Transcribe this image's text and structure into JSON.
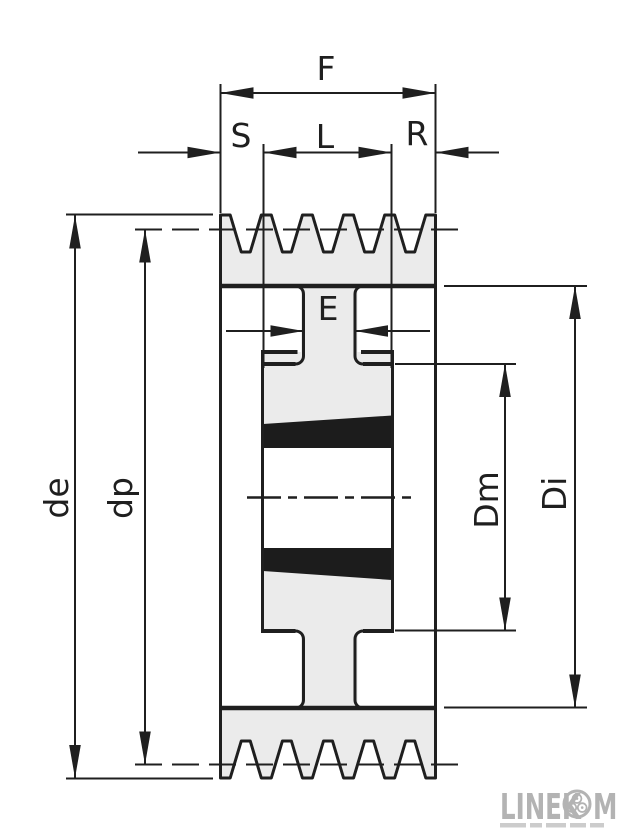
{
  "title": "V-belt pulley with taper bush - dimensioned cross-section",
  "labels": {
    "F": "F",
    "S": "S",
    "L": "L",
    "R": "R",
    "E": "E",
    "de": "de",
    "dp": "dp",
    "Dm": "Dm",
    "Di": "Di"
  },
  "colors": {
    "outline": "#1f1f1f",
    "section_fill": "#ebebeb",
    "background": "#ffffff",
    "taper_fill": "#1c1c1c",
    "logo_gray": "#b3b3b3",
    "tagline_gray": "#cccccc"
  },
  "logo": {
    "text_left": "LINEK",
    "text_right": "M",
    "badge": "three-roller-chain-badge",
    "tagline_legible": false
  },
  "geometry": {
    "canvas": {
      "w": 644,
      "h": 839
    },
    "pulley": {
      "left": 220.5,
      "right": 435.5,
      "top": 215,
      "bottom": 778,
      "groove_count": 5,
      "groove_floor_top": 252,
      "groove_floor_bottom": 741,
      "peak_flat": 10,
      "floor_w": 9,
      "rim_face_top": 286,
      "rim_face_bottom": 708,
      "web_left": 303.5,
      "web_right": 355,
      "hub_left": 262.5,
      "hub_right": 392.5,
      "hub_lip_top": 352,
      "hub_face_top": 364,
      "hub_face_bottom": 631,
      "bore_top": 448,
      "bore_bottom": 548,
      "band_top": [
        [
          263,
          424
        ],
        [
          392,
          415.5
        ],
        [
          392,
          448
        ],
        [
          263,
          448
        ]
      ],
      "band_bottom": [
        [
          263,
          548
        ],
        [
          392,
          548
        ],
        [
          392,
          580
        ],
        [
          263,
          571
        ]
      ],
      "center_y": 497.5,
      "center_x1": 247,
      "center_x2": 413,
      "fillet_r": 8
    },
    "dims": {
      "F": {
        "y": 93,
        "x1": 220.5,
        "x2": 435.5,
        "ext_y1": 84,
        "ext_y2": 213,
        "label": [
          326,
          80
        ]
      },
      "S": {
        "y": 152.5,
        "tail_x": 138,
        "tip_x": 220.5,
        "label": [
          241,
          147
        ]
      },
      "L": {
        "y": 152.5,
        "x1": 263.5,
        "x2": 391.5,
        "ext_y1": 144,
        "ext_y2": 368,
        "label": [
          325,
          148
        ]
      },
      "R": {
        "y": 152.5,
        "tail_x": 499,
        "tip_x": 435.5,
        "label": [
          417,
          145
        ]
      },
      "E": {
        "y": 331,
        "tail_left": 226,
        "tip_left": 303.5,
        "tip_right": 355,
        "tail_right": 430,
        "label": [
          328,
          320
        ]
      },
      "de": {
        "x": 75,
        "y1": 215.5,
        "y2": 778,
        "ext_x1": 66,
        "ext_x2": 213,
        "ext_y1": 214.5,
        "ext_y2": 778.5,
        "label": [
          68,
          498,
          -90
        ]
      },
      "dp": {
        "x": 145,
        "y1": 229.5,
        "y2": 764.5,
        "dash_x1": 135,
        "dash_x2": 459,
        "label": [
          132,
          498,
          -90
        ]
      },
      "Dm": {
        "x": 505,
        "y1": 364,
        "y2": 630.5,
        "ext_x1": 395,
        "ext_x2": 516,
        "label": [
          498,
          500,
          -90
        ]
      },
      "Di": {
        "x": 575,
        "y1": 286,
        "y2": 707.5,
        "ext_x1": 444,
        "ext_x2": 587,
        "label": [
          566,
          494,
          -90
        ]
      }
    },
    "logo_box": {
      "x": 500,
      "y": 792,
      "badge_cx": 577,
      "badge_cy": 804,
      "badge_r": 13
    }
  }
}
